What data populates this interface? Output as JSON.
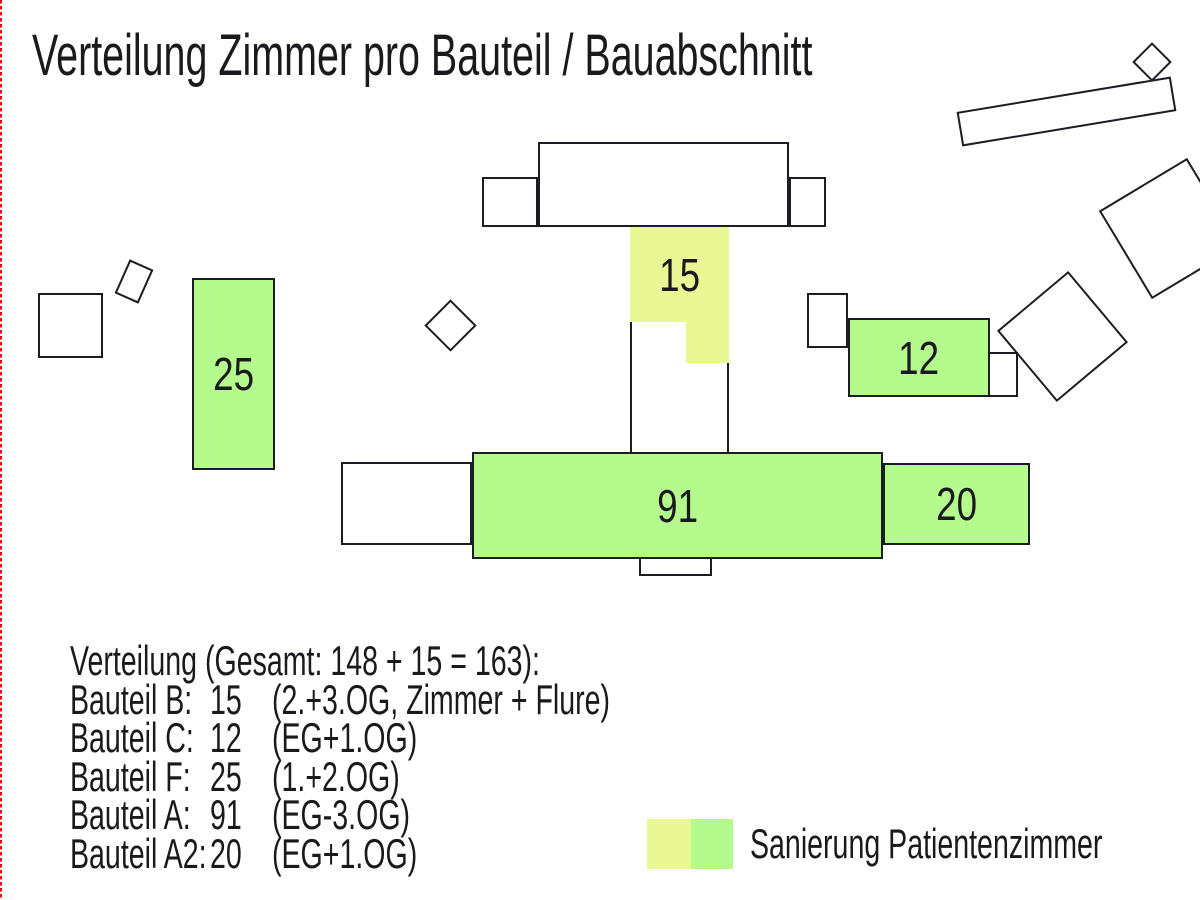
{
  "title": "Verteilung Zimmer pro Bauteil / Bauabschnitt",
  "colors": {
    "green": "#b4fa8c",
    "yellow": "#e9f795",
    "outline": "#1c1c24",
    "ink": "#1a1a1e",
    "crop_mark": "#ff0000"
  },
  "buildings": {
    "bauteil_b": {
      "value": "15"
    },
    "bauteil_c": {
      "value": "12"
    },
    "bauteil_f": {
      "value": "25"
    },
    "bauteil_a": {
      "value": "91"
    },
    "bauteil_a2": {
      "value": "20"
    }
  },
  "distribution": {
    "heading": "Verteilung (Gesamt: 148 + 15 = 163):",
    "rows": [
      {
        "label": "Bauteil B:",
        "value": "15",
        "note": "(2.+3.OG, Zimmer + Flure)"
      },
      {
        "label": "Bauteil C:",
        "value": "12",
        "note": "(EG+1.OG)"
      },
      {
        "label": "Bauteil F:",
        "value": "25",
        "note": "(1.+2.OG)"
      },
      {
        "label": "Bauteil A:",
        "value": "91",
        "note": "(EG-3.OG)"
      },
      {
        "label": "Bauteil A2:",
        "value": "20",
        "note": "(EG+1.OG)"
      }
    ]
  },
  "legend": {
    "label": "Sanierung Patientenzimmer"
  }
}
